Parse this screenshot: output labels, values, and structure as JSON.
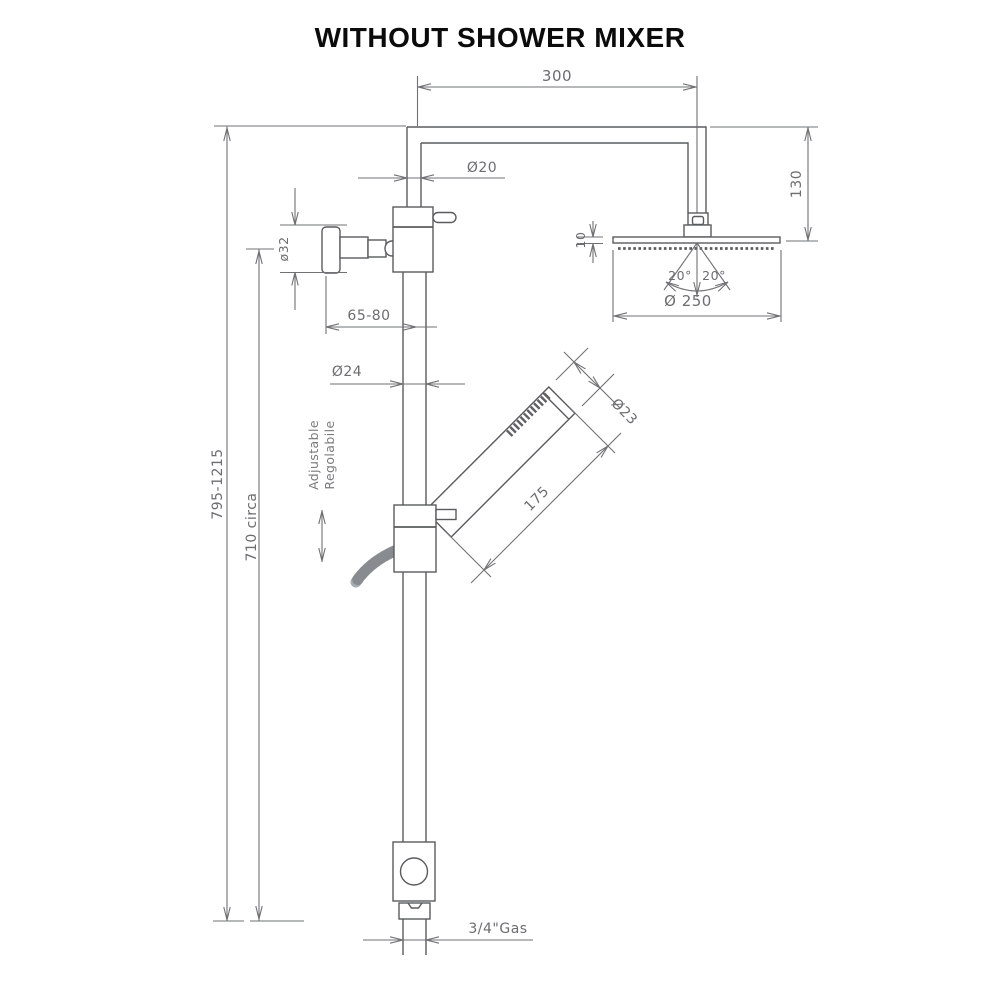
{
  "title": "WITHOUT SHOWER MIXER",
  "drawing": {
    "labels": {
      "arm_length": "300",
      "arm_diameter": "Ø20",
      "head_offset_height": "130",
      "head_thickness": "10",
      "swivel_angle_left": "20°",
      "swivel_angle_right": "20°",
      "head_diameter": "Ø 250",
      "wall_union_diameter": "ø32",
      "wall_clearance": "65-80",
      "column_diameter": "Ø24",
      "handshower_diameter": "Ø23",
      "handshower_length": "175",
      "total_height": "795-1215",
      "column_height": "710 circa",
      "connection_thread": "3/4\"Gas",
      "adjustable_en": "Adjustable",
      "adjustable_it": "Regolabile"
    },
    "colors": {
      "line": "#595b5e",
      "dim_text": "#6b6d70",
      "title": "#0b0b0b"
    }
  }
}
